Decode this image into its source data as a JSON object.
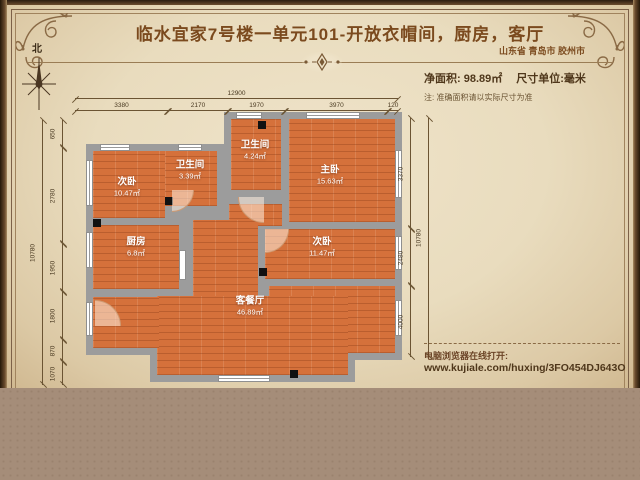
{
  "header": {
    "title": "临水宜家7号楼一单元101-开放衣帽间，厨房，客厅",
    "location": "山东省 青岛市 胶州市",
    "net_area": "净面积: 98.89㎡",
    "unit": "尺寸单位:毫米",
    "note": "注: 准确面积请以实际尺寸为准",
    "compass_label": "北"
  },
  "rooms": [
    {
      "name": "次卧",
      "area": "10.47㎡"
    },
    {
      "name": "卫生间",
      "area": "3.39㎡"
    },
    {
      "name": "卫生间",
      "area": "4.24㎡"
    },
    {
      "name": "主卧",
      "area": "15.63㎡"
    },
    {
      "name": "厨房",
      "area": "6.8㎡"
    },
    {
      "name": "次卧",
      "area": "11.47㎡"
    },
    {
      "name": "客餐厅",
      "area": "46.89㎡"
    }
  ],
  "dimensions": {
    "top_total": "12900",
    "top_segments": [
      "3380",
      "2170",
      "1970",
      "3970",
      "120"
    ],
    "left_total": "10780",
    "left_segments": [
      "650",
      "2780",
      "1950",
      "1800",
      "870",
      "1070"
    ],
    "right_total": "10780",
    "right_segments": [
      "3370",
      "2480",
      "4000"
    ]
  },
  "footer": {
    "open_hint": "电脑浏览器在线打开:",
    "url": "www.kujiale.com/huxing/3FO454DJ643O"
  },
  "colors": {
    "paper": "#e9dcbe",
    "accent_brown": "#7b4a1e",
    "wall_gray": "#9c9c9c",
    "floor_orange": "#d5713b",
    "bottom_band": "#a58d79"
  }
}
